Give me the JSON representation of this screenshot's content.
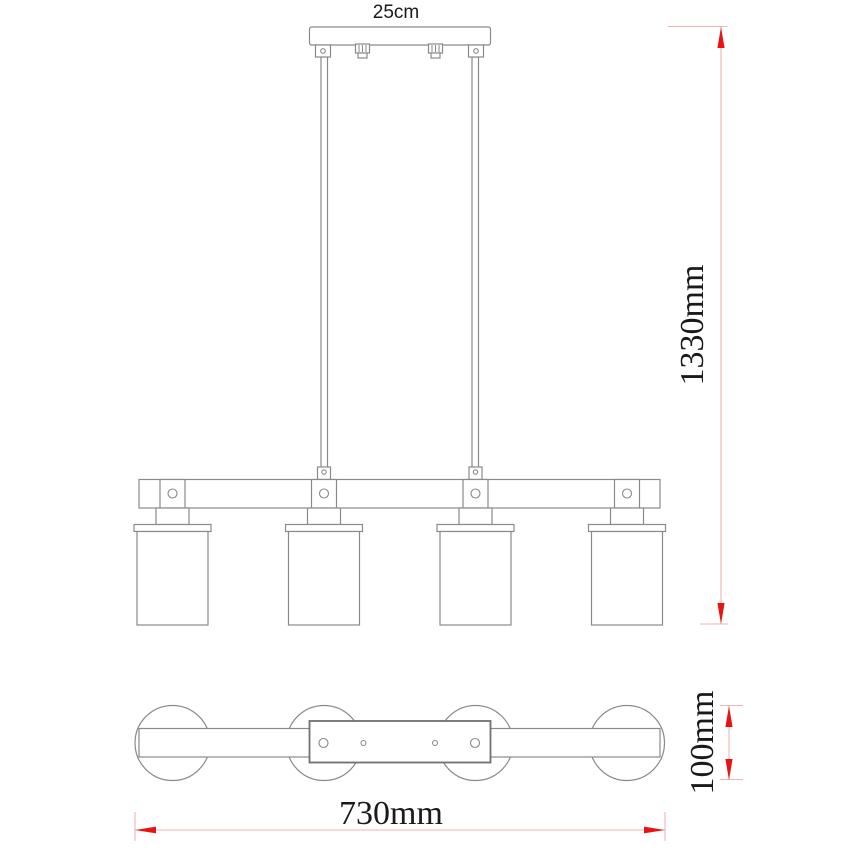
{
  "drawing": {
    "dimensions": {
      "canopy_width": "25cm",
      "overall_height": "1330mm",
      "overall_width": "730mm",
      "shade_diameter": "100mm"
    },
    "colors": {
      "outline": "#8a8a8a",
      "dimension_line": "#efb3b3",
      "arrow_red": "#e81414",
      "text": "#1a1a1a",
      "background": "#ffffff"
    }
  }
}
